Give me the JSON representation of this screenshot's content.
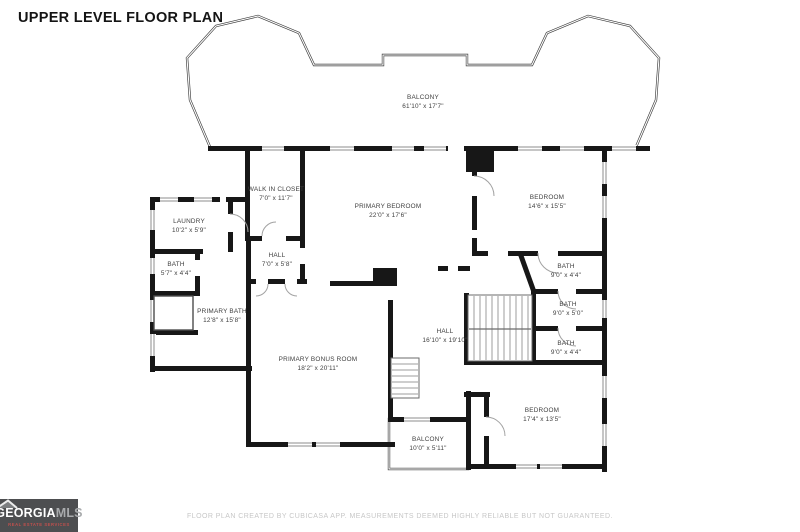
{
  "title": "UPPER LEVEL FLOOR PLAN",
  "footer": {
    "disclaimer": "FLOOR PLAN CREATED BY CUBICASA APP. MEASUREMENTS DEEMED HIGHLY RELIABLE BUT NOT GUARANTEED."
  },
  "logo": {
    "brand": "GEORGIA",
    "brand_suffix": "MLS",
    "tagline": "REAL ESTATE SERVICES"
  },
  "colors": {
    "wall": "#171717",
    "room_label": "#3f3f3f",
    "railing": "#3c3c3c",
    "footer_text": "#c7c7c7",
    "logo_background": "#4d4e50",
    "logo_tagline_red": "#c0504d"
  },
  "rooms": [
    {
      "name": "BALCONY",
      "dims": "61'10\" x 17'7\""
    },
    {
      "name": "WALK IN CLOSET",
      "dims": "7'0\" x 11'7\""
    },
    {
      "name": "LAUNDRY",
      "dims": "10'2\" x 5'9\""
    },
    {
      "name": "BATH",
      "dims": "5'7\" x 4'4\""
    },
    {
      "name": "PRIMARY BEDROOM",
      "dims": "22'0\" x 17'6\""
    },
    {
      "name": "BEDROOM",
      "dims": "14'6\" x 15'5\""
    },
    {
      "name": "HALL",
      "dims": "7'0\" x 5'8\""
    },
    {
      "name": "BATH",
      "dims": "9'0\" x 4'4\""
    },
    {
      "name": "PRIMARY BATH",
      "dims": "12'8\" x 15'8\""
    },
    {
      "name": "BATH",
      "dims": "9'0\" x 5'0\""
    },
    {
      "name": "HALL",
      "dims": "16'10\" x 19'10\""
    },
    {
      "name": "BATH",
      "dims": "9'0\" x 4'4\""
    },
    {
      "name": "PRIMARY BONUS ROOM",
      "dims": "18'2\" x 20'11\""
    },
    {
      "name": "BEDROOM",
      "dims": "17'4\" x 13'5\""
    },
    {
      "name": "BALCONY",
      "dims": "10'0\" x 5'11\""
    }
  ]
}
